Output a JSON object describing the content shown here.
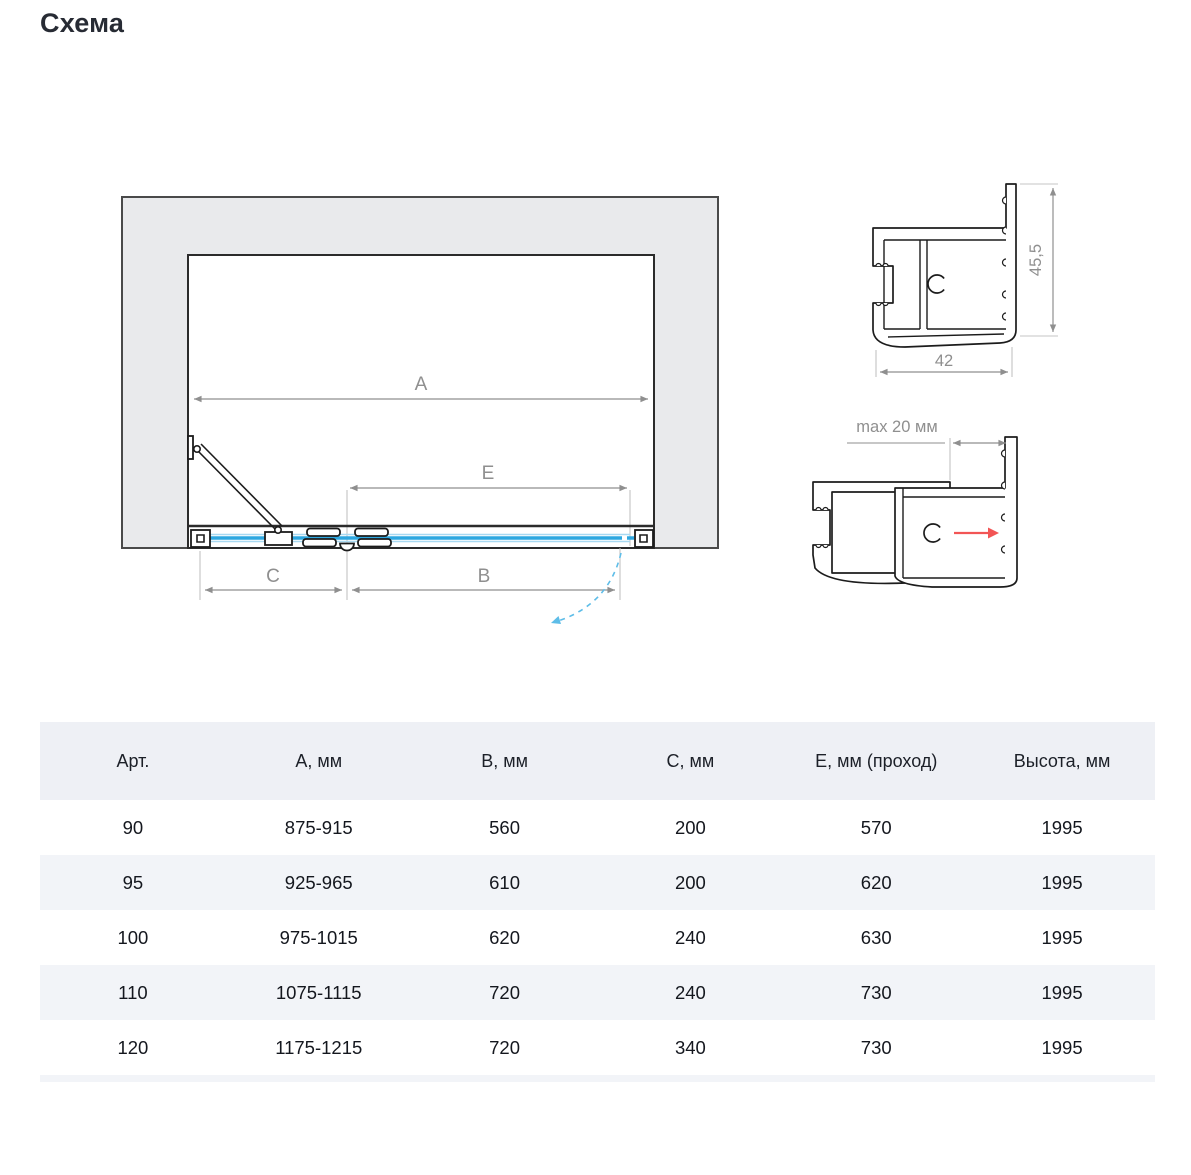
{
  "title": "Схема",
  "diagram": {
    "labels": {
      "a": "A",
      "b": "B",
      "c": "C",
      "e": "E"
    },
    "profile_top": {
      "height": "45,5",
      "width": "42"
    },
    "profile_bottom": {
      "max": "max 20 мм"
    },
    "colors": {
      "glass": "#2da7e0",
      "glass_light": "#a8d9f2",
      "swing_arc": "#5ebde8",
      "adjust_arrow": "#f25555",
      "dimension": "#8f8f8f",
      "wall_fill": "#e9eaec",
      "outline": "#1c1c1c"
    }
  },
  "table": {
    "headers": [
      "Арт.",
      "А, мм",
      "В, мм",
      "С, мм",
      "Е, мм (проход)",
      "Высота, мм"
    ],
    "rows": [
      [
        "90",
        "875-915",
        "560",
        "200",
        "570",
        "1995"
      ],
      [
        "95",
        "925-965",
        "610",
        "200",
        "620",
        "1995"
      ],
      [
        "100",
        "975-1015",
        "620",
        "240",
        "630",
        "1995"
      ],
      [
        "110",
        "1075-1115",
        "720",
        "240",
        "730",
        "1995"
      ],
      [
        "120",
        "1175-1215",
        "720",
        "340",
        "730",
        "1995"
      ]
    ]
  }
}
